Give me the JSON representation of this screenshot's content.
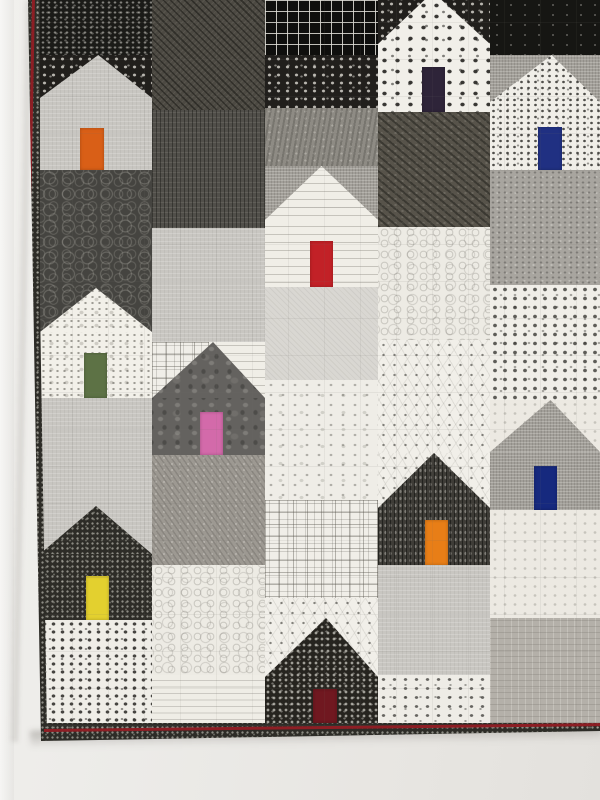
{
  "scene": {
    "type": "photograph",
    "subject": "modern patchwork quilt of house blocks in black, white and gray prints with brightly colored doors, hanging on a white wall",
    "wall_color": "#ebe9e5",
    "quilt_visible_edges": [
      "left",
      "bottom"
    ],
    "quilt_edge_geometry": {
      "left_top_x": 28,
      "left_bottom_x": 41,
      "bottom_y_left": 741,
      "bottom_y_right": 731
    }
  },
  "quilt": {
    "binding_fabric": "dark-speck",
    "piping_hex": "#8d1e24",
    "patches": [
      {
        "f": "black-dash",
        "x": 40,
        "y": 0,
        "w": 112,
        "h": 55
      },
      {
        "f": "dark-pebble",
        "x": 40,
        "y": 170,
        "w": 112,
        "h": 118
      },
      {
        "f": "gray-light",
        "x": 40,
        "y": 398,
        "w": 112,
        "h": 108
      },
      {
        "f": "white-smalldots",
        "x": 40,
        "y": 620,
        "w": 112,
        "h": 103
      },
      {
        "f": "charcoal-diag",
        "x": 152,
        "y": 0,
        "w": 113,
        "h": 110
      },
      {
        "f": "dark-vert",
        "x": 152,
        "y": 110,
        "w": 113,
        "h": 118
      },
      {
        "f": "gray-light",
        "x": 152,
        "y": 228,
        "w": 113,
        "h": 114
      },
      {
        "f": "taupe-diag",
        "x": 152,
        "y": 455,
        "w": 113,
        "h": 110
      },
      {
        "f": "white-swirl",
        "x": 152,
        "y": 565,
        "w": 113,
        "h": 110
      },
      {
        "f": "white-ledger",
        "x": 152,
        "y": 675,
        "w": 113,
        "h": 48
      },
      {
        "f": "black-grid",
        "x": 265,
        "y": 0,
        "w": 113,
        "h": 55
      },
      {
        "f": "black-dot",
        "x": 265,
        "y": 55,
        "w": 113,
        "h": 53
      },
      {
        "f": "gray-cater",
        "x": 265,
        "y": 108,
        "w": 113,
        "h": 58
      },
      {
        "f": "gray-lighter",
        "x": 265,
        "y": 287,
        "w": 113,
        "h": 93
      },
      {
        "f": "white-floral",
        "x": 265,
        "y": 380,
        "w": 113,
        "h": 120
      },
      {
        "f": "white-squares",
        "x": 265,
        "y": 500,
        "w": 113,
        "h": 98
      },
      {
        "f": "charcoal-diag2",
        "x": 378,
        "y": 112,
        "w": 112,
        "h": 115
      },
      {
        "f": "white-swirl",
        "x": 378,
        "y": 227,
        "w": 112,
        "h": 113
      },
      {
        "f": "white-constellation",
        "x": 378,
        "y": 340,
        "w": 112,
        "h": 113
      },
      {
        "f": "gray-light",
        "x": 378,
        "y": 565,
        "w": 112,
        "h": 110
      },
      {
        "f": "white-smalldots2",
        "x": 378,
        "y": 675,
        "w": 112,
        "h": 48
      },
      {
        "f": "black-solid",
        "x": 490,
        "y": 0,
        "w": 110,
        "h": 55
      },
      {
        "f": "gray-medium",
        "x": 490,
        "y": 170,
        "w": 110,
        "h": 115
      },
      {
        "f": "white-floraldots",
        "x": 490,
        "y": 285,
        "w": 110,
        "h": 115
      },
      {
        "f": "white-floral2",
        "x": 490,
        "y": 510,
        "w": 110,
        "h": 108
      },
      {
        "f": "taupe-text",
        "x": 490,
        "y": 618,
        "w": 110,
        "h": 105
      }
    ],
    "houses": [
      {
        "id": "top-left",
        "door_color": "orange",
        "door_hex": "#d95f17",
        "sky": [
          {
            "f": "black-dot",
            "x": 40,
            "y": 55,
            "w": 112,
            "h": 43
          }
        ],
        "roof": {
          "f": "gray-light",
          "x": 40,
          "y": 55,
          "w": 112,
          "h": 43,
          "peak": 52,
          "peak_y": 0
        },
        "body": {
          "f": "gray-light",
          "x": 40,
          "y": 98,
          "w": 112,
          "h": 72
        },
        "door": {
          "x": 80,
          "y": 128,
          "w": 24,
          "h": 42
        }
      },
      {
        "id": "top-middle",
        "door_color": "dark-purple",
        "door_hex": "#2e2439",
        "sky": [
          {
            "f": "black-dot",
            "x": 378,
            "y": 0,
            "w": 112,
            "h": 44
          }
        ],
        "roof": {
          "f": "white-dot",
          "x": 378,
          "y": 0,
          "w": 112,
          "h": 44,
          "peak": 49,
          "peak_y": -18
        },
        "body": {
          "f": "white-dot",
          "x": 378,
          "y": 44,
          "w": 112,
          "h": 68
        },
        "door": {
          "x": 422,
          "y": 67,
          "w": 23,
          "h": 45
        }
      },
      {
        "id": "top-right",
        "door_color": "navy",
        "door_hex": "#203082",
        "sky": [
          {
            "f": "gray-crosshatch",
            "x": 490,
            "y": 55,
            "w": 110,
            "h": 47
          }
        ],
        "roof": {
          "f": "white-dot2",
          "x": 490,
          "y": 55,
          "w": 110,
          "h": 47,
          "peak": 56,
          "peak_y": 0
        },
        "body": {
          "f": "white-dot2",
          "x": 490,
          "y": 102,
          "w": 110,
          "h": 68
        },
        "door": {
          "x": 538,
          "y": 127,
          "w": 24,
          "h": 43
        }
      },
      {
        "id": "middle",
        "door_color": "red",
        "door_hex": "#c22127",
        "sky": [
          {
            "f": "gray-crosshatch",
            "x": 265,
            "y": 166,
            "w": 113,
            "h": 54
          }
        ],
        "roof": {
          "f": "white-text",
          "x": 265,
          "y": 166,
          "w": 113,
          "h": 54,
          "peak": 50,
          "peak_y": 0
        },
        "body": {
          "f": "white-text",
          "x": 265,
          "y": 220,
          "w": 113,
          "h": 67
        },
        "door": {
          "x": 310,
          "y": 241,
          "w": 23,
          "h": 46
        }
      },
      {
        "id": "mid-left",
        "door_color": "green",
        "door_hex": "#5d7245",
        "sky": [
          {
            "f": "dark-pebble",
            "x": 40,
            "y": 288,
            "w": 112,
            "h": 44
          }
        ],
        "roof": {
          "f": "white-speckle",
          "x": 40,
          "y": 288,
          "w": 112,
          "h": 44,
          "peak": 50,
          "peak_y": 0
        },
        "body": {
          "f": "white-speckle",
          "x": 40,
          "y": 332,
          "w": 112,
          "h": 66
        },
        "door": {
          "x": 84,
          "y": 353,
          "w": 23,
          "h": 45
        }
      },
      {
        "id": "mid-center",
        "door_color": "pink",
        "door_hex": "#d36aaa",
        "sky": [
          {
            "f": "white-squares",
            "x": 152,
            "y": 342,
            "w": 57,
            "h": 56
          },
          {
            "f": "white-text",
            "x": 209,
            "y": 342,
            "w": 56,
            "h": 56
          }
        ],
        "roof": {
          "f": "batik",
          "x": 152,
          "y": 342,
          "w": 113,
          "h": 56,
          "peak": 54,
          "peak_y": 0
        },
        "body": {
          "f": "batik",
          "x": 152,
          "y": 398,
          "w": 113,
          "h": 57
        },
        "door": {
          "x": 200,
          "y": 412,
          "w": 23,
          "h": 43
        }
      },
      {
        "id": "lower-center",
        "door_color": "orange",
        "door_hex": "#e87e17",
        "sky": [
          {
            "f": "white-constellation",
            "x": 378,
            "y": 453,
            "w": 112,
            "h": 55
          }
        ],
        "roof": {
          "f": "dark-vert2",
          "x": 378,
          "y": 453,
          "w": 112,
          "h": 55,
          "peak": 50,
          "peak_y": 0
        },
        "body": {
          "f": "dark-vert2",
          "x": 378,
          "y": 508,
          "w": 112,
          "h": 57
        },
        "door": {
          "x": 425,
          "y": 520,
          "w": 23,
          "h": 45
        }
      },
      {
        "id": "lower-right",
        "door_color": "navy",
        "door_hex": "#16297e",
        "sky": [
          {
            "f": "white-floral2",
            "x": 490,
            "y": 400,
            "w": 110,
            "h": 52
          }
        ],
        "roof": {
          "f": "gray-crosshatch",
          "x": 490,
          "y": 400,
          "w": 110,
          "h": 52,
          "peak": 55,
          "peak_y": 0
        },
        "body": {
          "f": "gray-crosshatch",
          "x": 490,
          "y": 452,
          "w": 110,
          "h": 58
        },
        "door": {
          "x": 534,
          "y": 466,
          "w": 23,
          "h": 44
        }
      },
      {
        "id": "bottom-left",
        "door_color": "yellow",
        "door_hex": "#e3d02f",
        "sky": [
          {
            "f": "gray-light",
            "x": 40,
            "y": 506,
            "w": 112,
            "h": 48
          }
        ],
        "roof": {
          "f": "dark-speck",
          "x": 40,
          "y": 506,
          "w": 112,
          "h": 48,
          "peak": 50,
          "peak_y": 0
        },
        "body": {
          "f": "dark-speck",
          "x": 40,
          "y": 554,
          "w": 112,
          "h": 66
        },
        "door": {
          "x": 86,
          "y": 576,
          "w": 23,
          "h": 44
        }
      },
      {
        "id": "bottom-center",
        "door_color": "maroon",
        "door_hex": "#701820",
        "sky": [
          {
            "f": "white-constellation",
            "x": 265,
            "y": 598,
            "w": 113,
            "h": 79
          }
        ],
        "roof": {
          "f": "black-dot2",
          "x": 265,
          "y": 618,
          "w": 113,
          "h": 59,
          "peak": 54,
          "peak_y": 0
        },
        "body": {
          "f": "black-dot2",
          "x": 265,
          "y": 677,
          "w": 113,
          "h": 46
        },
        "door": {
          "x": 313,
          "y": 689,
          "w": 24,
          "h": 34
        }
      }
    ]
  }
}
